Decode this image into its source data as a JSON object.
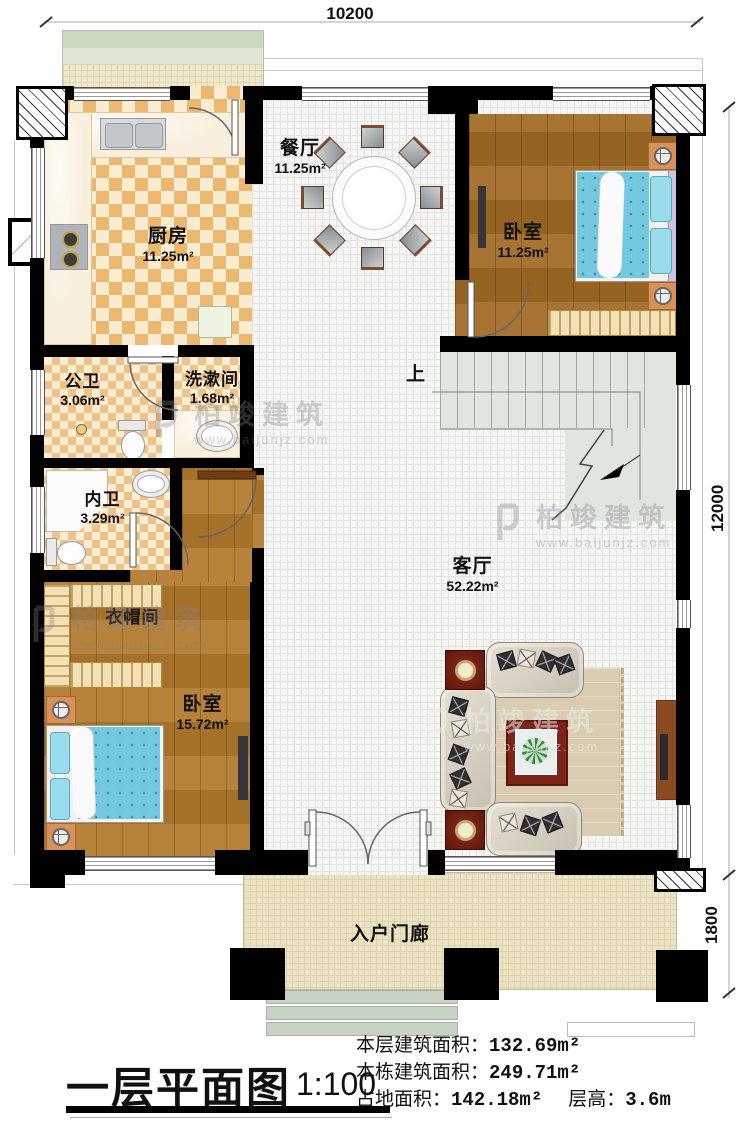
{
  "title": {
    "text": "一层平面图",
    "scale": "1:100"
  },
  "dimensions": {
    "top": "10200",
    "right_main": "12000",
    "right_porch": "1800"
  },
  "stair": {
    "up_label": "上"
  },
  "rooms": [
    {
      "id": "dining",
      "name": "餐厅",
      "area": "11.25m²"
    },
    {
      "id": "kitchen",
      "name": "厨房",
      "area": "11.25m²"
    },
    {
      "id": "bedroom-top",
      "name": "卧室",
      "area": "11.25m²"
    },
    {
      "id": "public-bath",
      "name": "公卫",
      "area": "3.06m²"
    },
    {
      "id": "washroom",
      "name": "洗漱间",
      "area": "1.68m²"
    },
    {
      "id": "ensuite-bath",
      "name": "内卫",
      "area": "3.29m²"
    },
    {
      "id": "cloakroom",
      "name": "衣帽间",
      "area": ""
    },
    {
      "id": "bedroom-bottom",
      "name": "卧室",
      "area": "15.72m²"
    },
    {
      "id": "living",
      "name": "客厅",
      "area": "52.22m²"
    },
    {
      "id": "porch",
      "name": "入户门廊",
      "area": ""
    }
  ],
  "stats": [
    {
      "label": "本层建筑面积：",
      "value": "132.69m²"
    },
    {
      "label": "本栋建筑面积：",
      "value": "249.71m²"
    },
    {
      "label": "占地面积：",
      "value": "142.18m²"
    },
    {
      "label": "层高：",
      "value": "3.6m"
    }
  ],
  "watermark": {
    "brand": "柏竣建筑",
    "url": "www.baijunjz.com"
  },
  "colors": {
    "wall": "#000000",
    "wood": "#ad7429",
    "floor_checker": "#ecb76f",
    "bed": "#74c9de",
    "stairs": "#e0e6dd",
    "porch_tile": "#ece3c5",
    "table_red": "#7c241a"
  }
}
